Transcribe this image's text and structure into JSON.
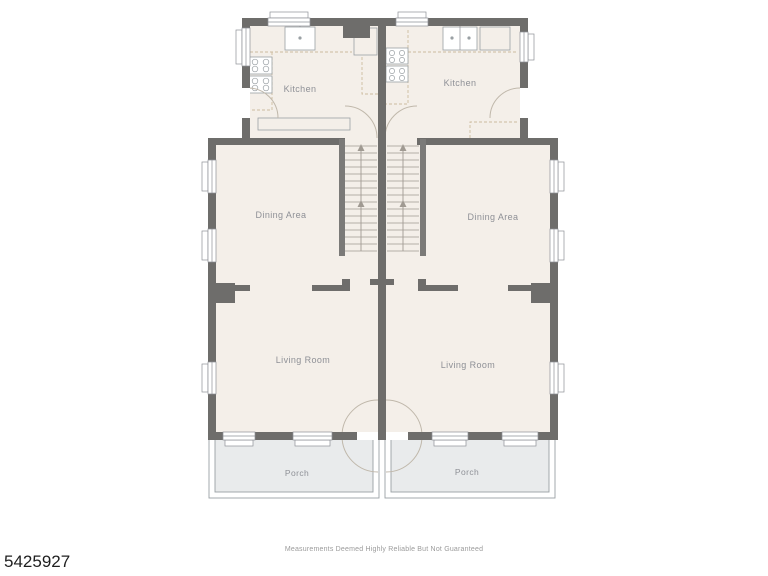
{
  "rooms": {
    "left": {
      "kitchen": "Kitchen",
      "dining": "Dining Area",
      "living": "Living Room",
      "porch": "Porch"
    },
    "right": {
      "kitchen": "Kitchen",
      "dining": "Dining Area",
      "living": "Living Room",
      "porch": "Porch"
    }
  },
  "footer": {
    "listing_id": "5425927",
    "disclaimer": "Measurements Deemed Highly Reliable But Not Guaranteed"
  },
  "colors": {
    "wall": "#6e6d6b",
    "floor": "#f4efe9",
    "porch": "#e9ebec",
    "outline": "#9aa0a4",
    "counter_dash": "#cdbb9e",
    "door_arc": "#c0b8ab",
    "label": "#8e9096",
    "id_text": "#1f1f1f",
    "disclaimer_text": "#9b9b9b"
  }
}
